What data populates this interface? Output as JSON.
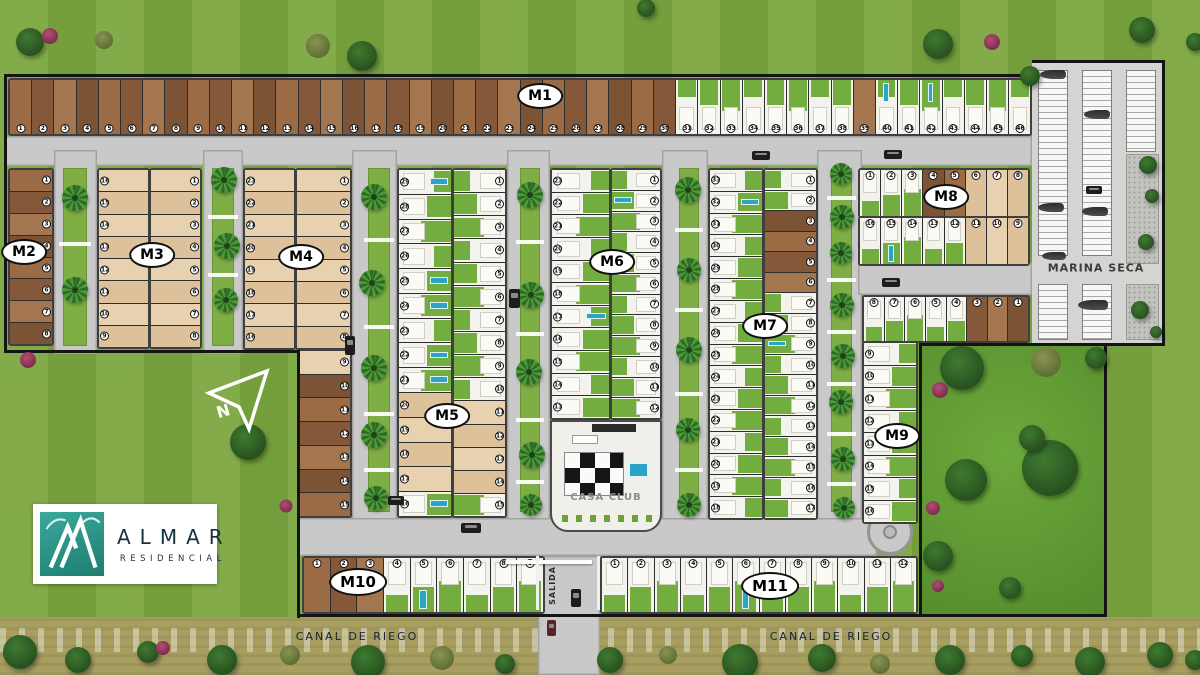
{
  "labels": {
    "marina_seca": "MARINA SECA",
    "casa_club": "CASA CLUB",
    "salida": "SALIDA",
    "canal_left": "CANAL DE RIEGO",
    "canal_right": "CANAL DE RIEGO"
  },
  "logo": {
    "title": "ALMAR",
    "subtitle": "RESIDENCIAL"
  },
  "compass": {
    "letter": "N"
  },
  "colors": {
    "grass": "#7CA740",
    "road": "#C9C9C9",
    "dirt": "#9A6B46",
    "sand": "#E7D0AC",
    "built": "#F3F2EC",
    "yard_green": "#74AD3F",
    "pool": "#2BA5C6",
    "water": "#7FCCC3",
    "canal_band": "#A79E60",
    "logo_teal": "#2E9D92",
    "boundary": "#141414",
    "label_navy": "#15253F"
  },
  "blocks": [
    {
      "id": "m1",
      "label": "M1",
      "strips": [
        {
          "lots": [
            [
              1,
              "d"
            ],
            [
              2,
              "d"
            ],
            [
              3,
              "d"
            ],
            [
              4,
              "d"
            ],
            [
              5,
              "d"
            ],
            [
              6,
              "d"
            ],
            [
              7,
              "d"
            ],
            [
              8,
              "d"
            ],
            [
              9,
              "d"
            ],
            [
              10,
              "d"
            ],
            [
              11,
              "d"
            ],
            [
              12,
              "d"
            ],
            [
              13,
              "d"
            ],
            [
              14,
              "d"
            ],
            [
              15,
              "d"
            ],
            [
              16,
              "d"
            ],
            [
              17,
              "d"
            ],
            [
              18,
              "d"
            ],
            [
              19,
              "d"
            ],
            [
              20,
              "d"
            ],
            [
              21,
              "d"
            ],
            [
              22,
              "d"
            ],
            [
              23,
              "d"
            ],
            [
              24,
              "d"
            ],
            [
              25,
              "d"
            ],
            [
              26,
              "d"
            ],
            [
              27,
              "d"
            ],
            [
              28,
              "d"
            ],
            [
              29,
              "d"
            ],
            [
              30,
              "d"
            ],
            [
              31,
              "b"
            ],
            [
              32,
              "b"
            ],
            [
              33,
              "b"
            ],
            [
              34,
              "b"
            ],
            [
              35,
              "b"
            ],
            [
              36,
              "b"
            ],
            [
              37,
              "b"
            ],
            [
              38,
              "b"
            ],
            [
              39,
              "d"
            ],
            [
              40,
              "p"
            ],
            [
              41,
              "b"
            ],
            [
              42,
              "p"
            ],
            [
              43,
              "b"
            ],
            [
              44,
              "b"
            ],
            [
              45,
              "b"
            ],
            [
              46,
              "b"
            ]
          ]
        }
      ]
    },
    {
      "id": "m2",
      "label": "M2",
      "strips": [
        {
          "lots": [
            [
              1,
              "d"
            ],
            [
              2,
              "d"
            ],
            [
              3,
              "d"
            ],
            [
              4,
              "d"
            ],
            [
              5,
              "d"
            ],
            [
              6,
              "d"
            ],
            [
              7,
              "d"
            ],
            [
              8,
              "d"
            ]
          ]
        }
      ]
    },
    {
      "id": "m3",
      "label": "M3",
      "strips": [
        {
          "lots": [
            [
              16,
              "t"
            ],
            [
              15,
              "t"
            ],
            [
              14,
              "t"
            ],
            [
              13,
              "t"
            ],
            [
              12,
              "t"
            ],
            [
              11,
              "t"
            ],
            [
              10,
              "t"
            ],
            [
              9,
              "t"
            ]
          ]
        },
        {
          "lots": [
            [
              1,
              "t"
            ],
            [
              2,
              "t"
            ],
            [
              3,
              "t"
            ],
            [
              4,
              "t"
            ],
            [
              5,
              "t"
            ],
            [
              6,
              "t"
            ],
            [
              7,
              "t"
            ],
            [
              8,
              "t"
            ]
          ]
        }
      ]
    },
    {
      "id": "m4",
      "label": "M4",
      "strips": [
        {
          "lots": [
            [
              23,
              "t"
            ],
            [
              22,
              "t"
            ],
            [
              21,
              "t"
            ],
            [
              20,
              "t"
            ],
            [
              19,
              "t"
            ],
            [
              18,
              "t"
            ],
            [
              17,
              "t"
            ],
            [
              16,
              "t"
            ]
          ]
        },
        {
          "lots": [
            [
              1,
              "t"
            ],
            [
              2,
              "t"
            ],
            [
              3,
              "t"
            ],
            [
              4,
              "t"
            ],
            [
              5,
              "t"
            ],
            [
              6,
              "t"
            ],
            [
              7,
              "t"
            ],
            [
              8,
              "t"
            ]
          ]
        },
        {
          "lots": [
            [
              9,
              "t"
            ],
            [
              10,
              "d"
            ],
            [
              11,
              "d"
            ],
            [
              12,
              "d"
            ],
            [
              13,
              "d"
            ],
            [
              14,
              "d"
            ],
            [
              15,
              "d"
            ]
          ]
        }
      ]
    },
    {
      "id": "m5",
      "label": "M5",
      "strips": [
        {
          "lots": [
            [
              29,
              "p"
            ],
            [
              28,
              "b"
            ],
            [
              27,
              "b"
            ],
            [
              26,
              "b"
            ],
            [
              25,
              "p"
            ],
            [
              24,
              "p"
            ],
            [
              23,
              "b"
            ],
            [
              22,
              "p"
            ],
            [
              21,
              "p"
            ],
            [
              20,
              "t"
            ],
            [
              19,
              "t"
            ],
            [
              18,
              "t"
            ],
            [
              17,
              "t"
            ],
            [
              16,
              "p"
            ]
          ]
        },
        {
          "lots": [
            [
              1,
              "b"
            ],
            [
              2,
              "b"
            ],
            [
              3,
              "b"
            ],
            [
              4,
              "b"
            ],
            [
              5,
              "b"
            ],
            [
              6,
              "b"
            ],
            [
              7,
              "b"
            ],
            [
              8,
              "b"
            ],
            [
              9,
              "b"
            ],
            [
              10,
              "b"
            ],
            [
              11,
              "t"
            ],
            [
              12,
              "t"
            ],
            [
              13,
              "t"
            ],
            [
              14,
              "t"
            ],
            [
              15,
              "b"
            ]
          ]
        }
      ]
    },
    {
      "id": "m6",
      "label": "M6",
      "strips": [
        {
          "lots": [
            [
              23,
              "b"
            ],
            [
              22,
              "b"
            ],
            [
              21,
              "b"
            ],
            [
              20,
              "b"
            ],
            [
              19,
              "b"
            ],
            [
              18,
              "b"
            ],
            [
              17,
              "p"
            ],
            [
              16,
              "b"
            ],
            [
              15,
              "b"
            ],
            [
              14,
              "b"
            ],
            [
              13,
              "b"
            ]
          ]
        },
        {
          "lots": [
            [
              1,
              "b"
            ],
            [
              2,
              "p"
            ],
            [
              3,
              "b"
            ],
            [
              4,
              "b"
            ],
            [
              5,
              "b"
            ],
            [
              6,
              "b"
            ],
            [
              7,
              "b"
            ],
            [
              8,
              "b"
            ],
            [
              9,
              "b"
            ],
            [
              10,
              "b"
            ],
            [
              11,
              "b"
            ],
            [
              12,
              "b"
            ]
          ]
        }
      ]
    },
    {
      "id": "m7",
      "label": "M7",
      "strips": [
        {
          "lots": [
            [
              33,
              "b"
            ],
            [
              32,
              "p"
            ],
            [
              31,
              "b"
            ],
            [
              30,
              "b"
            ],
            [
              29,
              "b"
            ],
            [
              28,
              "b"
            ],
            [
              27,
              "b"
            ],
            [
              26,
              "b"
            ],
            [
              25,
              "b"
            ],
            [
              24,
              "b"
            ],
            [
              23,
              "b"
            ],
            [
              22,
              "b"
            ],
            [
              21,
              "b"
            ],
            [
              20,
              "b"
            ],
            [
              19,
              "b"
            ],
            [
              18,
              "b"
            ]
          ]
        },
        {
          "lots": [
            [
              1,
              "b"
            ],
            [
              2,
              "b"
            ],
            [
              3,
              "d"
            ],
            [
              4,
              "d"
            ],
            [
              5,
              "d"
            ],
            [
              6,
              "d"
            ],
            [
              7,
              "b"
            ],
            [
              8,
              "b"
            ],
            [
              9,
              "p"
            ],
            [
              10,
              "b"
            ],
            [
              11,
              "b"
            ],
            [
              12,
              "b"
            ],
            [
              13,
              "b"
            ],
            [
              14,
              "b"
            ],
            [
              15,
              "b"
            ],
            [
              16,
              "b"
            ],
            [
              17,
              "b"
            ]
          ]
        }
      ]
    },
    {
      "id": "m8",
      "label": "M8",
      "strips": [
        {
          "lots": [
            [
              1,
              "b"
            ],
            [
              2,
              "b"
            ],
            [
              3,
              "b"
            ],
            [
              4,
              "d"
            ],
            [
              5,
              "d"
            ],
            [
              6,
              "t"
            ],
            [
              7,
              "t"
            ],
            [
              8,
              "t"
            ]
          ]
        },
        {
          "lots": [
            [
              16,
              "b"
            ],
            [
              15,
              "p"
            ],
            [
              14,
              "b"
            ],
            [
              13,
              "b"
            ],
            [
              12,
              "b"
            ],
            [
              11,
              "t"
            ],
            [
              10,
              "t"
            ],
            [
              9,
              "t"
            ]
          ]
        }
      ]
    },
    {
      "id": "m9",
      "label": "M9",
      "strips": [
        {
          "lots": [
            [
              8,
              "b"
            ],
            [
              7,
              "b"
            ],
            [
              6,
              "b"
            ],
            [
              5,
              "b"
            ],
            [
              4,
              "b"
            ],
            [
              3,
              "d"
            ],
            [
              2,
              "d"
            ],
            [
              1,
              "d"
            ]
          ]
        },
        {
          "lots": [
            [
              9,
              "b"
            ],
            [
              10,
              "b"
            ],
            [
              11,
              "b"
            ],
            [
              12,
              "b"
            ],
            [
              13,
              "b"
            ],
            [
              14,
              "b"
            ],
            [
              15,
              "b"
            ],
            [
              16,
              "b"
            ]
          ]
        }
      ]
    },
    {
      "id": "m10",
      "label": "M10",
      "strips": [
        {
          "lots": [
            [
              1,
              "d"
            ],
            [
              2,
              "d"
            ],
            [
              3,
              "d"
            ],
            [
              4,
              "b"
            ],
            [
              5,
              "p"
            ],
            [
              6,
              "b"
            ],
            [
              7,
              "b"
            ],
            [
              8,
              "b"
            ],
            [
              9,
              "b"
            ]
          ]
        }
      ]
    },
    {
      "id": "m11",
      "label": "M11",
      "strips": [
        {
          "lots": [
            [
              1,
              "b"
            ],
            [
              2,
              "b"
            ],
            [
              3,
              "b"
            ],
            [
              4,
              "b"
            ],
            [
              5,
              "b"
            ],
            [
              6,
              "p"
            ],
            [
              7,
              "b"
            ],
            [
              8,
              "b"
            ],
            [
              9,
              "b"
            ],
            [
              10,
              "b"
            ],
            [
              11,
              "b"
            ],
            [
              12,
              "b"
            ]
          ]
        }
      ]
    }
  ]
}
